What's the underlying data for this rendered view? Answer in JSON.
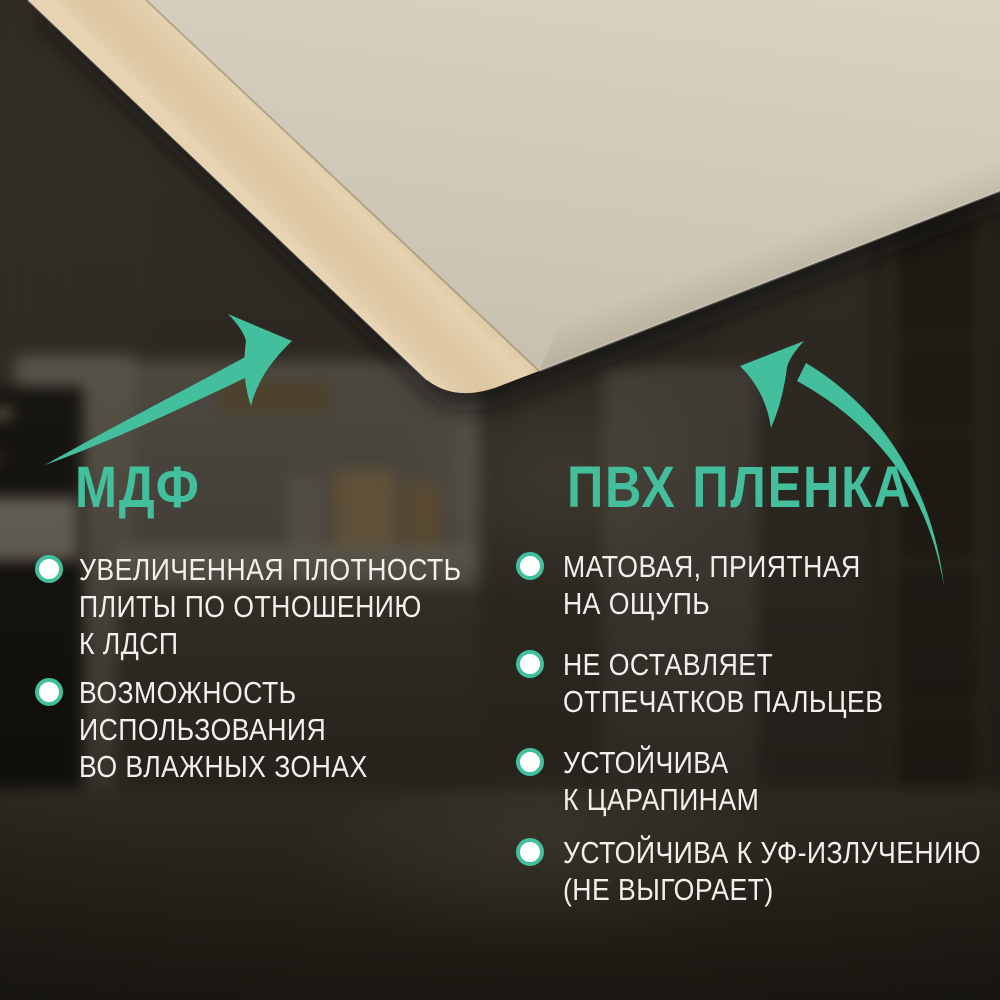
{
  "colors": {
    "accent": "#43BF9E",
    "text": "#F2F0EC",
    "film": "#CFC8B7",
    "mdf_edge": "#E2CBA6",
    "background_base": "#353129"
  },
  "scene": {
    "background": "darkened kitchen interior photo",
    "object": "corner of MDF board wrapped in cream PVC film"
  },
  "columns": {
    "left": {
      "heading": "МДФ",
      "items": [
        {
          "lines": [
            "УВЕЛИЧЕННАЯ ПЛОТНОСТЬ",
            "ПЛИТЫ ПО ОТНОШЕНИЮ",
            "К ЛДСП"
          ]
        },
        {
          "lines": [
            "ВОЗМОЖНОСТЬ",
            "ИСПОЛЬЗОВАНИЯ",
            "ВО ВЛАЖНЫХ ЗОНАХ"
          ]
        }
      ]
    },
    "right": {
      "heading": "ПВХ ПЛЕНКА",
      "items": [
        {
          "lines": [
            "МАТОВАЯ, ПРИЯТНАЯ",
            "НА ОЩУПЬ"
          ]
        },
        {
          "lines": [
            "НЕ ОСТАВЛЯЕТ",
            "ОТПЕЧАТКОВ ПАЛЬЦЕВ"
          ]
        },
        {
          "lines": [
            "УСТОЙЧИВА",
            "К ЦАРАПИНАМ"
          ]
        },
        {
          "lines": [
            "УСТОЙЧИВА К УФ-ИЗЛУЧЕНИЮ",
            "(НЕ ВЫГОРАЕТ)"
          ]
        }
      ]
    }
  }
}
